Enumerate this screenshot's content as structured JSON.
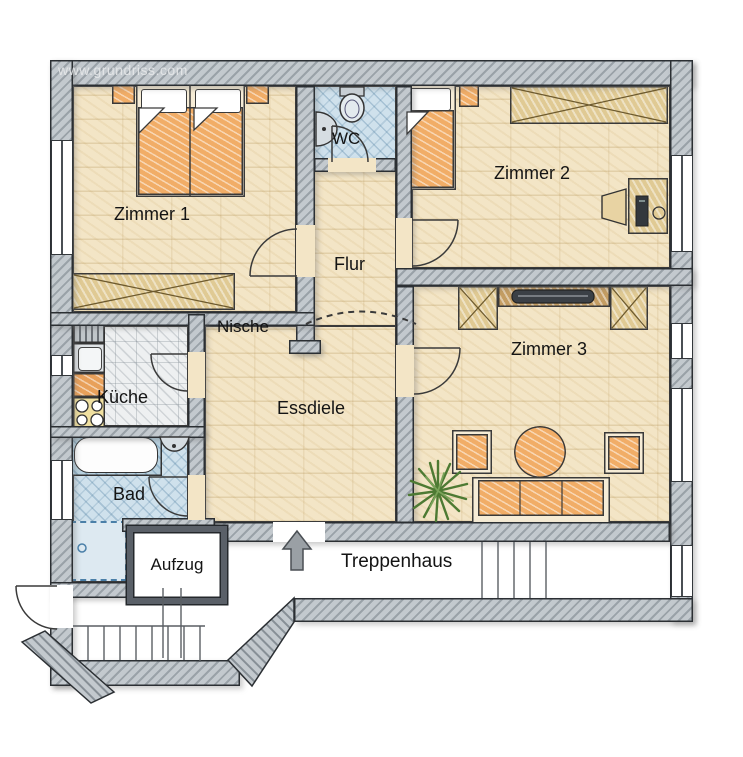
{
  "watermark": "www.grundriss.com",
  "rooms": {
    "zimmer1": {
      "label": "Zimmer 1"
    },
    "zimmer2": {
      "label": "Zimmer 2"
    },
    "zimmer3": {
      "label": "Zimmer 3"
    },
    "wc": {
      "label": "WC"
    },
    "flur": {
      "label": "Flur"
    },
    "nische": {
      "label": "Nische"
    },
    "kueche": {
      "label": "Küche"
    },
    "essdiele": {
      "label": "Essdiele"
    },
    "bad": {
      "label": "Bad"
    },
    "aufzug": {
      "label": "Aufzug"
    },
    "treppenhaus": {
      "label": "Treppenhaus"
    }
  },
  "colors": {
    "wall": "#c3c9ce",
    "wood_floor": "#f3e5c6",
    "bath_floor": "#cfe1ec",
    "tile_floor": "#eef0f1",
    "furniture_orange": "#f1ad67",
    "furniture_wood": "#e0ca94",
    "plant_green": "#4d7a33",
    "arrow_gray": "#9aa0a5"
  }
}
